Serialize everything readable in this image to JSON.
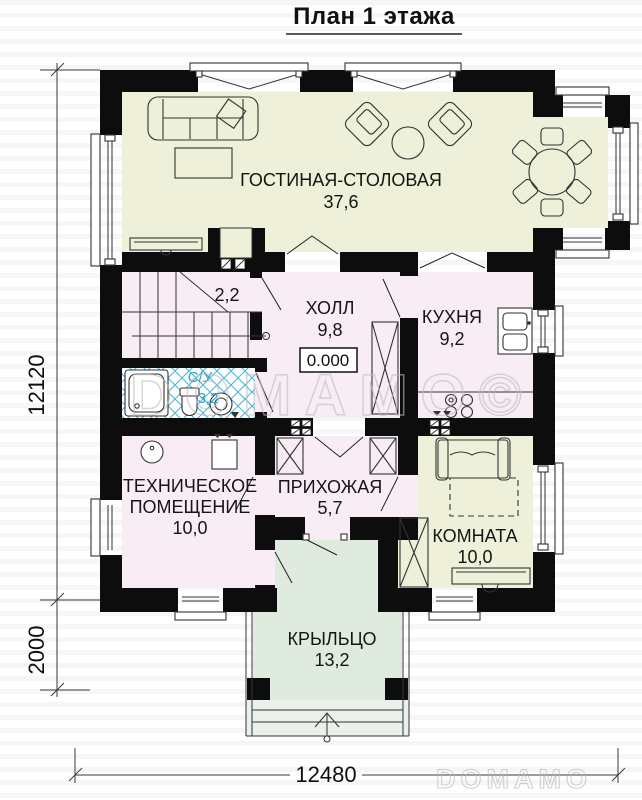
{
  "title": "План 1 этажа",
  "rooms": {
    "living": {
      "name": "ГОСТИНАЯ-СТОЛОВАЯ",
      "area": "37,6"
    },
    "stair_closet": {
      "area": "2,2"
    },
    "hall": {
      "name": "ХОЛЛ",
      "area": "9,8"
    },
    "kitchen": {
      "name": "КУХНЯ",
      "area": "9,2"
    },
    "bathroom": {
      "name": "С/У",
      "area": "3,2"
    },
    "technical": {
      "name_line1": "ТЕХНИЧЕСКОЕ",
      "name_line2": "ПОМЕЩЕНИЕ",
      "area": "10,0"
    },
    "entry_hall": {
      "name": "ПРИХОЖАЯ",
      "area": "5,7"
    },
    "room": {
      "name": "КОМНАТА",
      "area": "10,0"
    },
    "porch": {
      "name": "КРЫЛЬЦО",
      "area": "13,2"
    }
  },
  "elevation_mark": "0.000",
  "dimensions": {
    "height_total": "12120",
    "porch_depth": "2000",
    "width_total": "12480"
  },
  "watermark": {
    "center": "DOMAMO©",
    "corner": "DOMAMO"
  },
  "colors": {
    "wall": "#0d0d0d",
    "living_fill": "#eef0d9",
    "pink_fill": "#f8edf4",
    "porch_fill": "#e0ebe0",
    "tile_blue": "#45b5d8",
    "bath_label": "#2ba6cb"
  }
}
